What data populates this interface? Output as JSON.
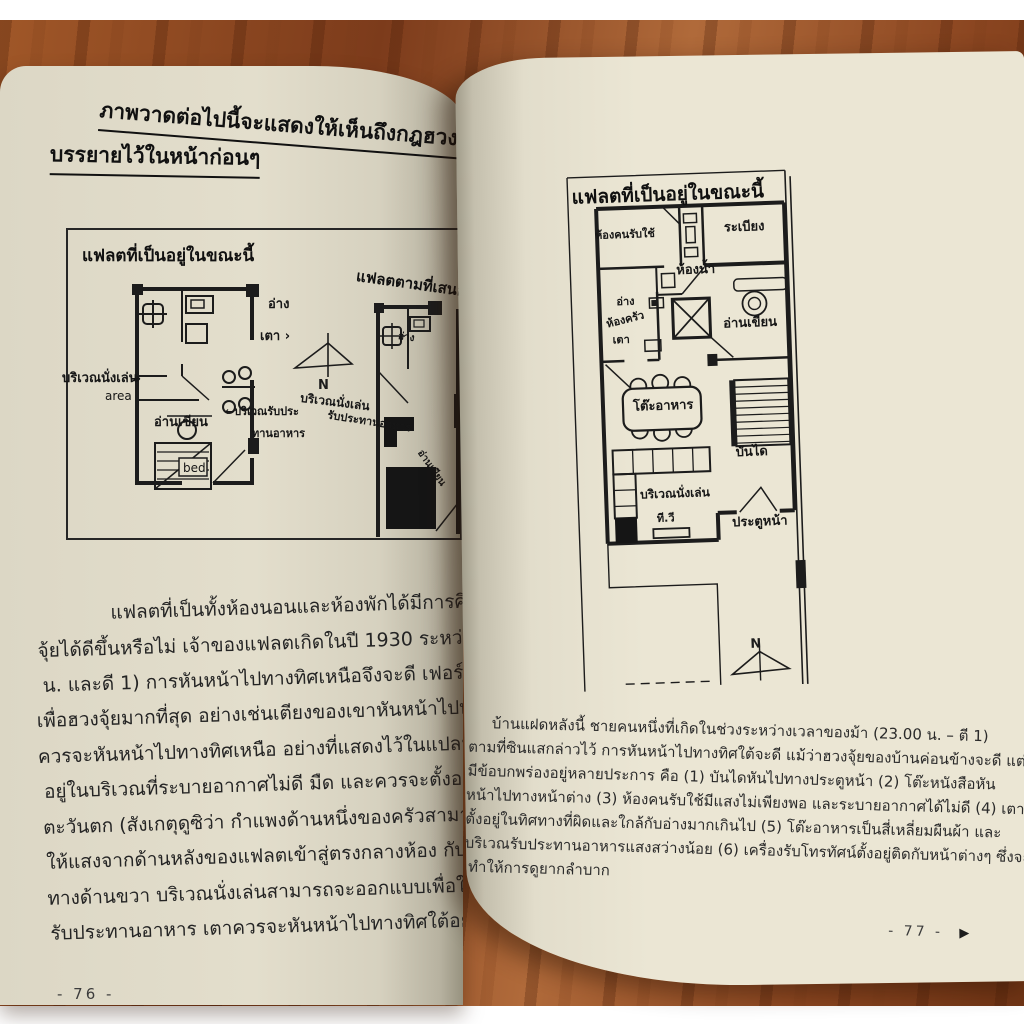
{
  "book": {
    "left_page": {
      "page_number": "- 76 -",
      "heading_line1": "ภาพวาดต่อไปนี้จะแสดงให้เห็นถึงกฎฮวงจุ้ย",
      "heading_line2": "บรรยายไว้ในหน้าก่อนๆ",
      "figure": {
        "plan_current_title": "แฟลตที่เป็นอยู่ในขณะนี้",
        "plan_proposed_title": "แฟลตตามที่เสนอ",
        "north_label": "N",
        "plan_current_labels": {
          "sink": "อ่าง",
          "stove": "เตา ›",
          "sitting_area": "บริเวณนั่งเล่น",
          "sitting_area_en": "area",
          "sitting_arrow": "→",
          "reading": "อ่านเขียน",
          "bed": "bed",
          "dining_line1": "←บริเวณรับประ",
          "dining_line2": "ทานอาหาร"
        },
        "plan_proposed_labels": {
          "sink": "อ่าง",
          "sitting_area": "บริเวณนั่งเล่น",
          "dining": "รับประทานอาหาร",
          "reading": "อ่านเขียน"
        }
      },
      "body_lines": [
        "แฟลตที่เป็นทั้งห้องนอนและห้องพักได้มีการศึกษาดูว่า",
        "จุ้ยได้ดีขึ้นหรือไม่ เจ้าของแฟลตเกิดในปี 1930 ระหว่างช่วงเวลา",
        "น. และดี 1) การหันหน้าไปทางทิศเหนือจึงจะดี เฟอร์นิเจอร์",
        "เพื่อฮวงจุ้ยมากที่สุด อย่างเช่นเตียงของเขาหันหน้าไปทางทิศ",
        "ควรจะหันหน้าไปทางทิศเหนือ อย่างที่แสดงไว้ในแปลนที่เสนอ",
        "อยู่ในบริเวณที่ระบายอากาศไม่ดี มืด และควรจะตั้งอยู่",
        "ตะวันตก (สังเกตุดูซิว่า กำแพงด้านหนึ่งของครัวสามารถ",
        "ให้แสงจากด้านหลังของแฟลตเข้าสู่ตรงกลางห้อง กับตัวเตียง",
        "ทางด้านขวา บริเวณนั่งเล่นสามารถจะออกแบบเพื่อใช้เป็นบริเวณ",
        "รับประทานอาหาร เตาควรจะหันหน้าไปทางทิศใต้อย่างที่แสดง"
      ]
    },
    "right_page": {
      "page_number": "- 77 -",
      "next_marker": "▶",
      "figure": {
        "title": "แฟลตที่เป็นอยู่ในขณะนี้",
        "north_label": "N",
        "labels": {
          "servant_room": "ห้องคนรับใช้",
          "balcony": "ระเบียง",
          "bathroom": "ห้องน้ำ",
          "sink": "อ่าง",
          "kitchen": "ห้องครัว",
          "stove": "เตา",
          "reading": "อ่านเขียน",
          "dining_table": "โต๊ะอาหาร",
          "stairs": "บันได",
          "sitting_area": "บริเวณนั่งเล่น",
          "tv": "ที.วี",
          "front_door": "ประตูหน้า"
        }
      },
      "body_lines": [
        "บ้านแฝดหลังนี้ ชายคนหนึ่งที่เกิดในช่วงระหว่างเวลาของม้า (23.00 น. – ตี 1)",
        "ตามที่ซินแสกล่าวไว้ การหันหน้าไปทางทิศใต้จะดี แม้ว่าฮวงจุ้ยของบ้านค่อนข้างจะดี แต่ก็",
        "มีข้อบกพร่องอยู่หลายประการ คือ (1) บันไดหันไปทางประตูหน้า (2) โต๊ะหนังสือหัน",
        "หน้าไปทางหน้าต่าง (3) ห้องคนรับใช้มีแสงไม่เพียงพอ และระบายอากาศได้ไม่ดี (4) เตา",
        "ตั้งอยู่ในทิศทางที่ผิดและใกล้กับอ่างมากเกินไป (5) โต๊ะอาหารเป็นสี่เหลี่ยมผืนผ้า และ",
        "บริเวณรับประทานอาหารแสงสว่างน้อย (6) เครื่องรับโทรทัศน์ตั้งอยู่ติดกับหน้าต่างๆ ซึ่งจะ",
        "ทำให้การดูยากลำบาก"
      ]
    }
  },
  "colors": {
    "wood": "#8a4a26",
    "page_left": "#dcd7c5",
    "page_right": "#ebe6d4",
    "ink": "#1d1d1d"
  }
}
